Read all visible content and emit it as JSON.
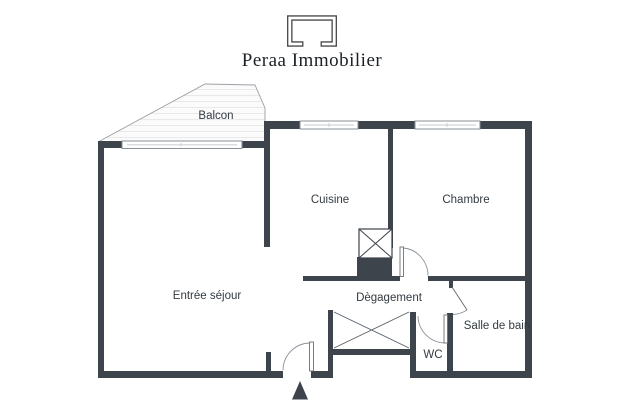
{
  "header": {
    "brand": "Peraa Immobilier",
    "logo": "bracket-logo"
  },
  "floorplan": {
    "rooms": [
      {
        "id": "balcon",
        "label": "Balcon"
      },
      {
        "id": "cuisine",
        "label": "Cuisine"
      },
      {
        "id": "chambre",
        "label": "Chambre"
      },
      {
        "id": "entree-sejour",
        "label": "Entrée séjour"
      },
      {
        "id": "degagement",
        "label": "Dègagement"
      },
      {
        "id": "salle-de-bain",
        "label": "Salle de bain"
      },
      {
        "id": "wc",
        "label": "WC"
      }
    ],
    "symbols": [
      "window",
      "door-arc",
      "duct-cross",
      "closet-cross",
      "entrance-arrow"
    ],
    "colors": {
      "wall": "#3d444b",
      "label_text": "#333b42",
      "brand_text": "#1d2126",
      "window_frame": "#8a9097",
      "balcony_outline": "#9aa0a6",
      "balcony_fill": "#fbfbfb"
    }
  }
}
